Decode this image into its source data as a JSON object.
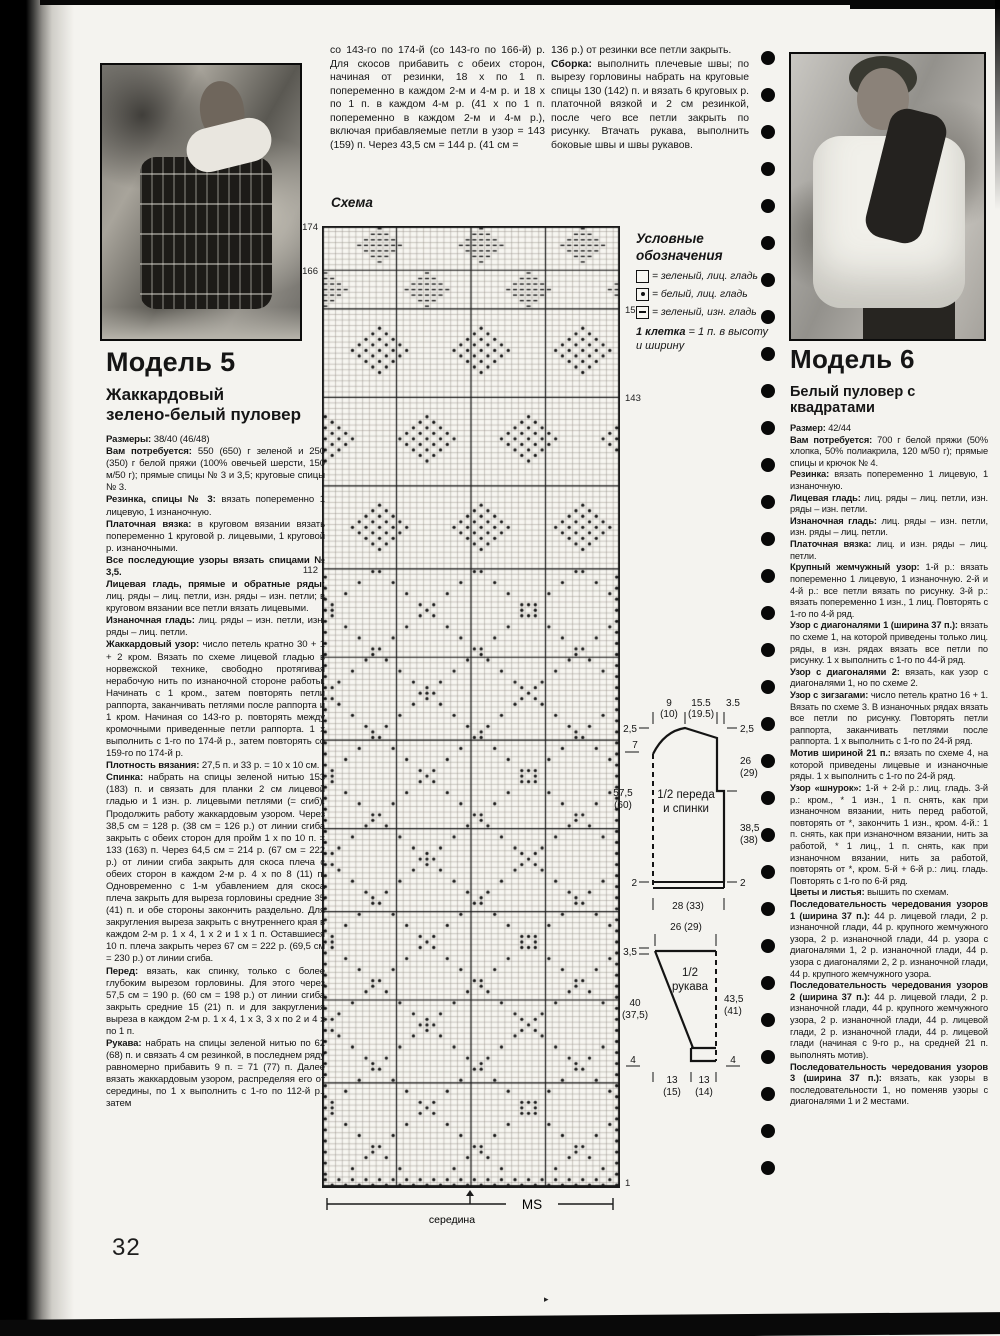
{
  "page": {
    "number": "32"
  },
  "top_columns": {
    "left": "со 143-го по 174-й (со 143-го по 166-й) р. Для скосов прибавить с обеих сторон, начиная от резинки, 18 х по 1 п. попеременно в каждом 2-м и 4-м р. и 18 х по 1 п. в каждом 4-м р. (41 х по 1 п. попеременно в каждом 2-м и 4-м р.), включая прибавляемые петли в узор = 143 (159) п. Через 43,5 см = 144 р. (41 см =",
    "right": [
      {
        "label": "",
        "text": "136 р.) от резинки все петли закрыть."
      },
      {
        "label": "Сборка:",
        "text": "выполнить плечевые швы; по вырезу горловины набрать на круговые спицы 130 (142) п. и вязать 6 круговых р. платочной вязкой и 2 см резинкой, после чего все петли закрыть по рисунку. Втачать рукава, выполнить боковые швы и швы рукавов."
      }
    ]
  },
  "model5": {
    "title": "Модель 5",
    "subtitle_line1": "Жаккардовый",
    "subtitle_line2": "зелено-белый пуловер",
    "paragraphs": [
      {
        "label": "Размеры:",
        "text": "38/40 (46/48)"
      },
      {
        "label": "Вам потребуется:",
        "text": "550 (650) г зеленой и 250 (350) г белой пряжи (100% овечьей шерсти, 150 м/50 г); прямые спицы № 3 и 3,5; круговые спицы № 3."
      },
      {
        "label": "Резинка, спицы № 3:",
        "text": "вязать попеременно 1 лицевую, 1 изнаночную."
      },
      {
        "label": "Платочная вязка:",
        "text": "в круговом вязании вязать попеременно 1 круговой р. лицевыми, 1 круговой р. изнаночными."
      },
      {
        "label": "Все последующие узоры вязать спицами № 3,5.",
        "text": ""
      },
      {
        "label": "Лицевая гладь, прямые и обратные ряды:",
        "text": "лиц. ряды – лиц. петли, изн. ряды – изн. петли; в круговом вязании все петли вязать лицевыми."
      },
      {
        "label": "Изнаночная гладь:",
        "text": "лиц. ряды – изн. петли, изн. ряды – лиц. петли."
      },
      {
        "label": "Жаккардовый узор:",
        "text": "число петель кратно 30 + 1 + 2 кром. Вязать по схеме лицевой гладью в норвежской технике, свободно протягивая нерабочую нить по изнаночной стороне работы. Начинать с 1 кром., затем повторять петли раппорта, заканчивать петлями после раппорта и 1 кром. Начиная со 143-го р. повторять между кромочными приведенные петли раппорта. 1 х выполнить с 1-го по 174-й р., затем повторять со 159-го по 174-й р."
      },
      {
        "label": "Плотность вязания:",
        "text": "27,5 п. и 33 р. = 10 х 10 см."
      },
      {
        "label": "Спинка:",
        "text": "набрать на спицы зеленой нитью 153 (183) п. и связать для планки 2 см лицевой гладью и 1 изн. р. лицевыми петлями (= сгиб). Продолжить работу жаккардовым узором. Через 38,5 см = 128 р. (38 см = 126 р.) от линии сгиба закрыть с обеих сторон для пройм 1 х по 10 п. = 133 (163) п. Через 64,5 см = 214 р. (67 см = 222 р.) от линии сгиба закрыть для скоса плеча с обеих сторон в каждом 2-м р. 4 х по 8 (11) п. Одновременно с 1-м убавлением для скоса плеча закрыть для выреза горловины средние 35 (41) п. и обе стороны закончить раздельно. Для закругления выреза закрыть с внутреннего края в каждом 2-м р. 1 х 4, 1 х 2 и 1 х 1 п. Оставшиеся 10 п. плеча закрыть через 67 см = 222 р. (69,5 см = 230 р.) от линии сгиба."
      },
      {
        "label": "Перед:",
        "text": "вязать, как спинку, только с более глубоким вырезом горловины. Для этого через 57,5 см = 190 р. (60 см = 198 р.) от линии сгиба закрыть средние 15 (21) п. и для закругления выреза в каждом 2-м р. 1 х 4, 1 х 3, 3 х по 2 и 4 х по 1 п."
      },
      {
        "label": "Рукава:",
        "text": "набрать на спицы зеленой нитью по 62 (68) п. и связать 4 см резинкой, в последнем ряду равномерно прибавить 9 п. = 71 (77) п. Далее вязать жаккардовым узором, распределяя его от середины, по 1 х выполнить с 1-го по 112-й р., затем"
      }
    ]
  },
  "model6": {
    "title": "Модель 6",
    "subtitle": "Белый пуловер с квадратами",
    "paragraphs": [
      {
        "label": "Размер:",
        "text": "42/44"
      },
      {
        "label": "Вам потребуется:",
        "text": "700 г белой пряжи (50% хлопка, 50% полиакрила, 120 м/50 г); прямые спицы и крючок № 4."
      },
      {
        "label": "Резинка:",
        "text": "вязать попеременно 1 лицевую, 1 изнаночную."
      },
      {
        "label": "Лицевая гладь:",
        "text": "лиц. ряды – лиц. петли, изн. ряды – изн. петли."
      },
      {
        "label": "Изнаночная гладь:",
        "text": "лиц. ряды – изн. петли, изн. ряды – лиц. петли."
      },
      {
        "label": "Платочная вязка:",
        "text": "лиц. и изн. ряды – лиц. петли."
      },
      {
        "label": "Крупный жемчужный узор:",
        "text": "1-й р.: вязать попеременно 1 лицевую, 1 изнаночную. 2-й и 4-й р.: все петли вязать по рисунку. 3-й р.: вязать попеременно 1 изн., 1 лиц. Повторять с 1-го по 4-й ряд."
      },
      {
        "label": "Узор с диагоналями 1 (ширина 37 п.):",
        "text": "вязать по схеме 1, на которой приведены только лиц. ряды, в изн. рядах вязать все петли по рисунку. 1 х выполнить с 1-го по 44-й ряд."
      },
      {
        "label": "Узор с диагоналями 2:",
        "text": "вязать, как узор с диагоналями 1, но по схеме 2."
      },
      {
        "label": "Узор с зигзагами:",
        "text": "число петель кратно 16 + 1. Вязать по схеме 3. В изнаночных рядах вязать все петли по рисунку. Повторять петли раппорта, заканчивать петлями после раппорта. 1 х выполнить с 1-го по 24-й ряд."
      },
      {
        "label": "Мотив шириной 21 п.:",
        "text": "вязать по схеме 4, на которой приведены лицевые и изнаночные ряды. 1 х выполнить с 1-го по 24-й ряд."
      },
      {
        "label": "Узор «шнурок»:",
        "text": "1-й + 2-й р.: лиц. гладь. 3-й р.: кром., * 1 изн., 1 п. снять, как при изнаночном вязании, нить перед работой, повторять от *, закончить 1 изн., кром. 4-й.: 1 п. снять, как при изнаночном вязании, нить за работой, * 1 лиц., 1 п. снять, как при изнаночном вязании, нить за работой, повторять от *, кром. 5-й + 6-й р.: лиц. гладь. Повторять с 1-го по 6-й ряд."
      },
      {
        "label": "Цветы и листья:",
        "text": "вышить по схемам."
      },
      {
        "label": "Последовательность чередования узоров 1 (ширина 37 п.):",
        "text": "44 р. лицевой глади, 2 р. изнаночной глади, 44 р. крупного жемчужного узора, 2 р. изнаночной глади, 44 р. узора с диагоналями 1, 2 р. изнаночной глади, 44 р. узора с диагоналями 2, 2 р. изнаночной глади, 44 р. крупного жемчужного узора."
      },
      {
        "label": "Последовательность чередования узоров 2 (ширина 37 п.):",
        "text": "44 р. лицевой глади, 2 р. изнаночной глади, 44 р. крупного жемчужного узора, 2 р. изнаночной глади, 44 р. лицевой глади, 2 р. изнаночной глади, 44 р. лицевой глади (начиная с 9-го р., на средней 21 п. выполнять мотив)."
      },
      {
        "label": "Последовательность чередования узоров 3 (ширина 37 п.):",
        "text": "вязать, как узоры в последовательности 1, но поменяв узоры с диагоналями 1 и 2 местами."
      }
    ]
  },
  "chart": {
    "title": "Схема",
    "rows_total": 174,
    "row_labels": [
      {
        "row": 174,
        "side": "left",
        "text": "174"
      },
      {
        "row": 166,
        "side": "left",
        "text": "166"
      },
      {
        "row": 112,
        "side": "left",
        "text": "112"
      },
      {
        "row": 159,
        "side": "right",
        "text": "159"
      },
      {
        "row": 143,
        "side": "right",
        "text": "143"
      },
      {
        "row": 1,
        "side": "right",
        "text": "1"
      }
    ],
    "ms_label": "MS",
    "center_label": "середина",
    "colors": {
      "grid": "#9a958d",
      "symbol": "#141414",
      "bold_line": "#1a1a1a",
      "background": "#f7f6f1"
    },
    "legend": {
      "title": "Условные обозначения",
      "items": [
        {
          "symbol": "empty-square",
          "text": "= зеленый, лиц. гладь"
        },
        {
          "symbol": "dot-square",
          "text": "= белый, лиц. гладь"
        },
        {
          "symbol": "dash-square",
          "text": "= зеленый, изн. гладь"
        }
      ],
      "note_label": "1 клетка",
      "note_text": " = 1 п. в высоту и ширину"
    }
  },
  "schematics": {
    "body": {
      "label_line1": "1/2 переда",
      "label_line2": "и спинки",
      "top_w1": "9",
      "top_w1b": "(10)",
      "top_w2": "15.5",
      "top_w2b": "(19.5)",
      "top_w3": "3.5",
      "left_neck": "2,5",
      "left_band": "7",
      "left_len": "57,5",
      "left_len_b": "(60)",
      "left_hem": "2",
      "right_neck": "2,5",
      "right_yoke": "26",
      "right_yoke_b": "(29)",
      "right_side": "38,5",
      "right_side_b": "(38)",
      "right_hem": "2",
      "bottom_w": "28 (33)"
    },
    "sleeve": {
      "label_line1": "1/2",
      "label_line2": "рукава",
      "top_w": "26 (29)",
      "left_cap": "3,5",
      "left_len": "40",
      "left_len_b": "(37,5)",
      "right_len": "43,5",
      "right_len_b": "(41)",
      "hem_left": "4",
      "hem_right": "4",
      "bottom_w1": "13",
      "bottom_w1b": "(15)",
      "bottom_w2": "13",
      "bottom_w2b": "(14)"
    }
  },
  "decor": {
    "punch_holes": 31,
    "speck": "▸"
  }
}
